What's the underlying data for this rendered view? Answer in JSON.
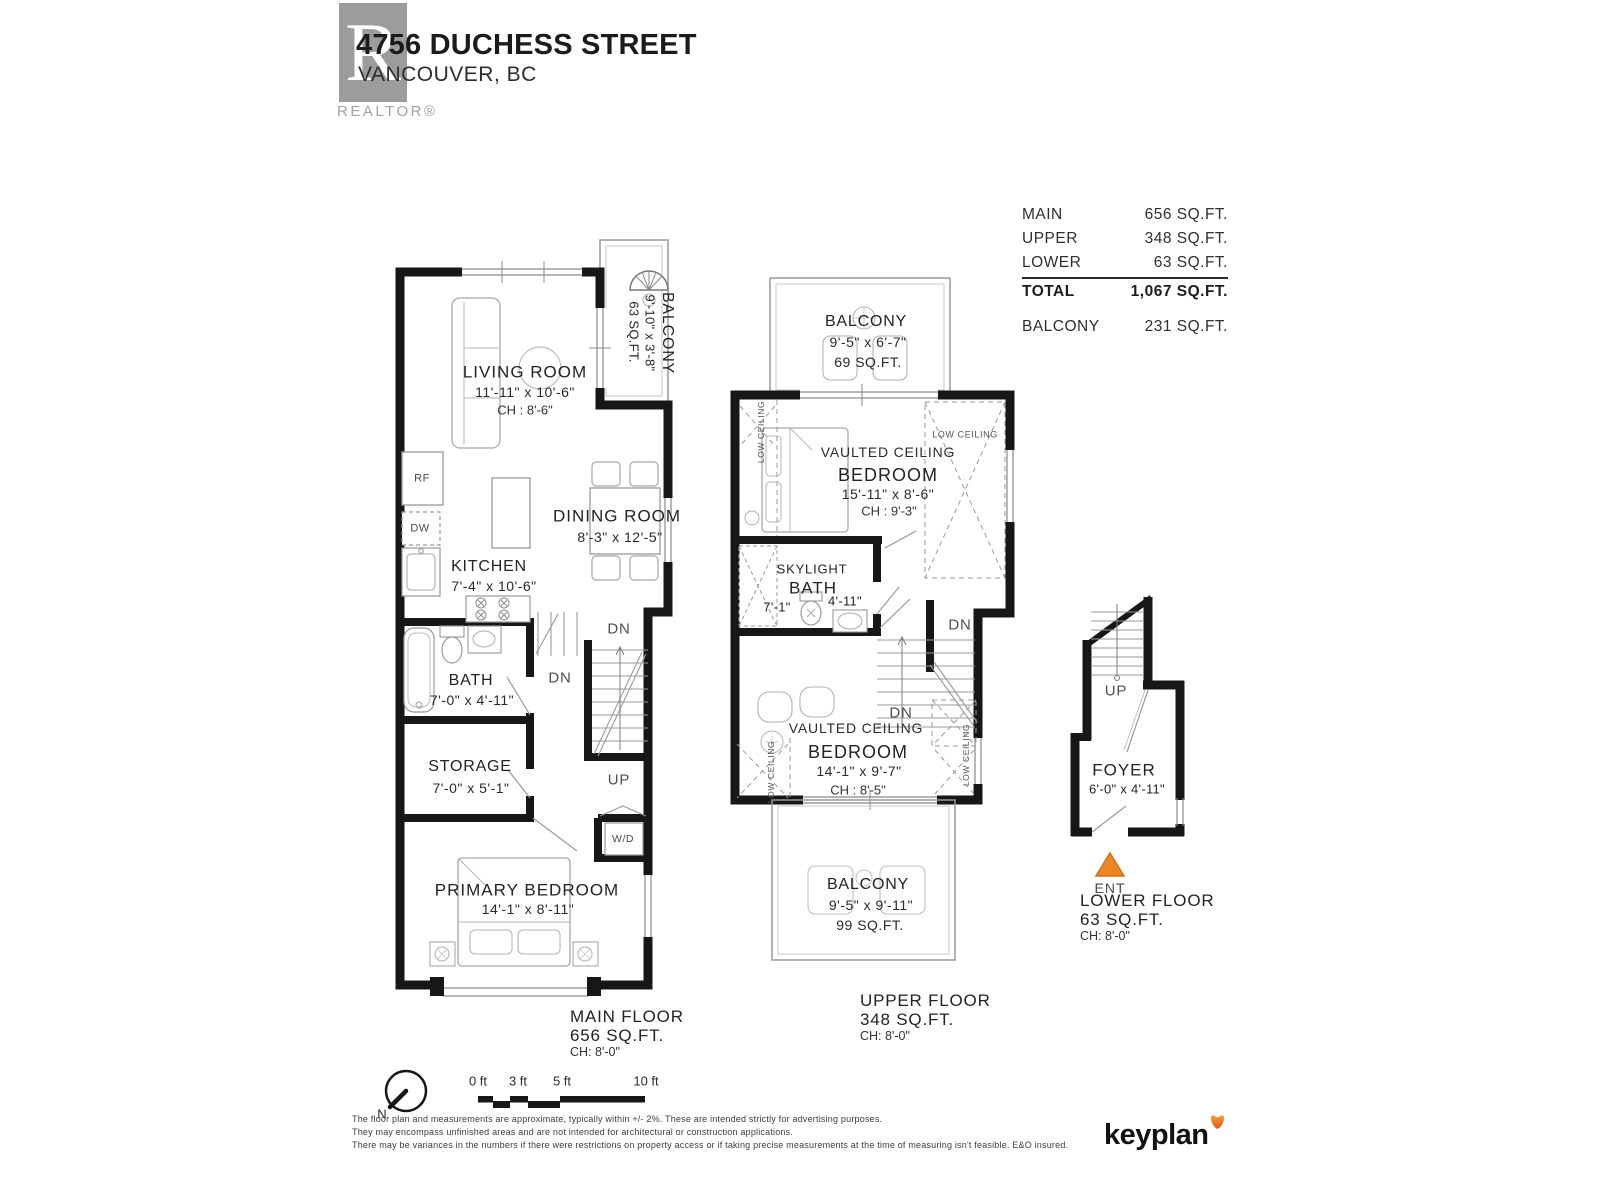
{
  "header": {
    "logo_letter": "R",
    "logo_wordmark": "REALTOR®",
    "address": "4756 DUCHESS STREET",
    "city": "VANCOUVER, BC"
  },
  "summary": {
    "rows": [
      {
        "label": "MAIN",
        "value": "656 SQ.FT."
      },
      {
        "label": "UPPER",
        "value": "348 SQ.FT."
      },
      {
        "label": "LOWER",
        "value": "63 SQ.FT."
      }
    ],
    "total_label": "TOTAL",
    "total_value": "1,067 SQ.FT.",
    "balcony_label": "BALCONY",
    "balcony_value": "231 SQ.FT."
  },
  "main_floor": {
    "balcony": {
      "name": "BALCONY",
      "dims": "9'-10\" x 3'-8\"",
      "area": "63 SQ.FT."
    },
    "living": {
      "name": "LIVING ROOM",
      "dims": "11'-11\" x 10'-6\"",
      "ch": "CH : 8'-6\""
    },
    "dining": {
      "name": "DINING ROOM",
      "dims": "8'-3\" x 12'-5\""
    },
    "kitchen": {
      "name": "KITCHEN",
      "dims": "7'-4\" x 10'-6\"",
      "rf": "RF",
      "dw": "DW"
    },
    "bath": {
      "name": "BATH",
      "dims": "7'-0\" x 4'-11\""
    },
    "storage": {
      "name": "STORAGE",
      "dims": "7'-0\" x 5'-1\""
    },
    "primary_bedroom": {
      "name": "PRIMARY BEDROOM",
      "dims": "14'-1\" x 8'-11\""
    },
    "wd": "W/D",
    "dn1": "DN",
    "dn2": "DN",
    "up": "UP",
    "caption": {
      "title": "MAIN FLOOR",
      "area": "656 SQ.FT.",
      "ch": "CH: 8'-0\""
    }
  },
  "upper_floor": {
    "balcony_top": {
      "name": "BALCONY",
      "dims": "9'-5\" x 6'-7\"",
      "area": "69 SQ.FT."
    },
    "bedroom_front": {
      "vaulted": "VAULTED CEILING",
      "name": "BEDROOM",
      "dims": "15'-11\" x 8'-6\"",
      "ch": "CH : 9'-3\"",
      "low_left": "LOW CEILING",
      "low_right": "LOW CEILING"
    },
    "bath": {
      "skylight": "SKYLIGHT",
      "name": "BATH",
      "dim1": "7'-1\"",
      "dim2": "4'-11\""
    },
    "bedroom_back": {
      "vaulted": "VAULTED CEILING",
      "name": "BEDROOM",
      "dims": "14'-1\" x 9'-7\"",
      "ch": "CH : 8'-5\"",
      "low_left": "LOW CEILING",
      "low_right": "LOW CEILING"
    },
    "balcony_bottom": {
      "name": "BALCONY",
      "dims": "9'-5\" x 9'-11\"",
      "area": "99 SQ.FT."
    },
    "dn1": "DN",
    "dn2": "DN",
    "caption": {
      "title": "UPPER FLOOR",
      "area": "348 SQ.FT.",
      "ch": "CH: 8'-0\""
    }
  },
  "lower_floor": {
    "up": "UP",
    "foyer": {
      "name": "FOYER",
      "dims": "6'-0\" x 4'-11\""
    },
    "ent": "ENT",
    "caption": {
      "title": "LOWER FLOOR",
      "area": "63 SQ.FT.",
      "ch": "CH: 8'-0\""
    }
  },
  "footer": {
    "north": "N",
    "scale_ticks": [
      "0 ft",
      "3 ft",
      "5 ft",
      "10 ft"
    ],
    "disclaimer": [
      "The floor plan and measurements are approximate, typically within +/- 2%. These are intended strictly for advertising purposes.",
      "They may encompass unfinished areas and are not intended for architectural or construction applications.",
      "There may be variances in the numbers if there were restrictions on property access or if taking precise measurements at the time of measuring isn't feasible. E&O insured."
    ],
    "brand": "keyplan"
  },
  "colors": {
    "wall": "#171717",
    "accent_orange": "#ee8722",
    "logo_gray": "#9c9c9c"
  }
}
